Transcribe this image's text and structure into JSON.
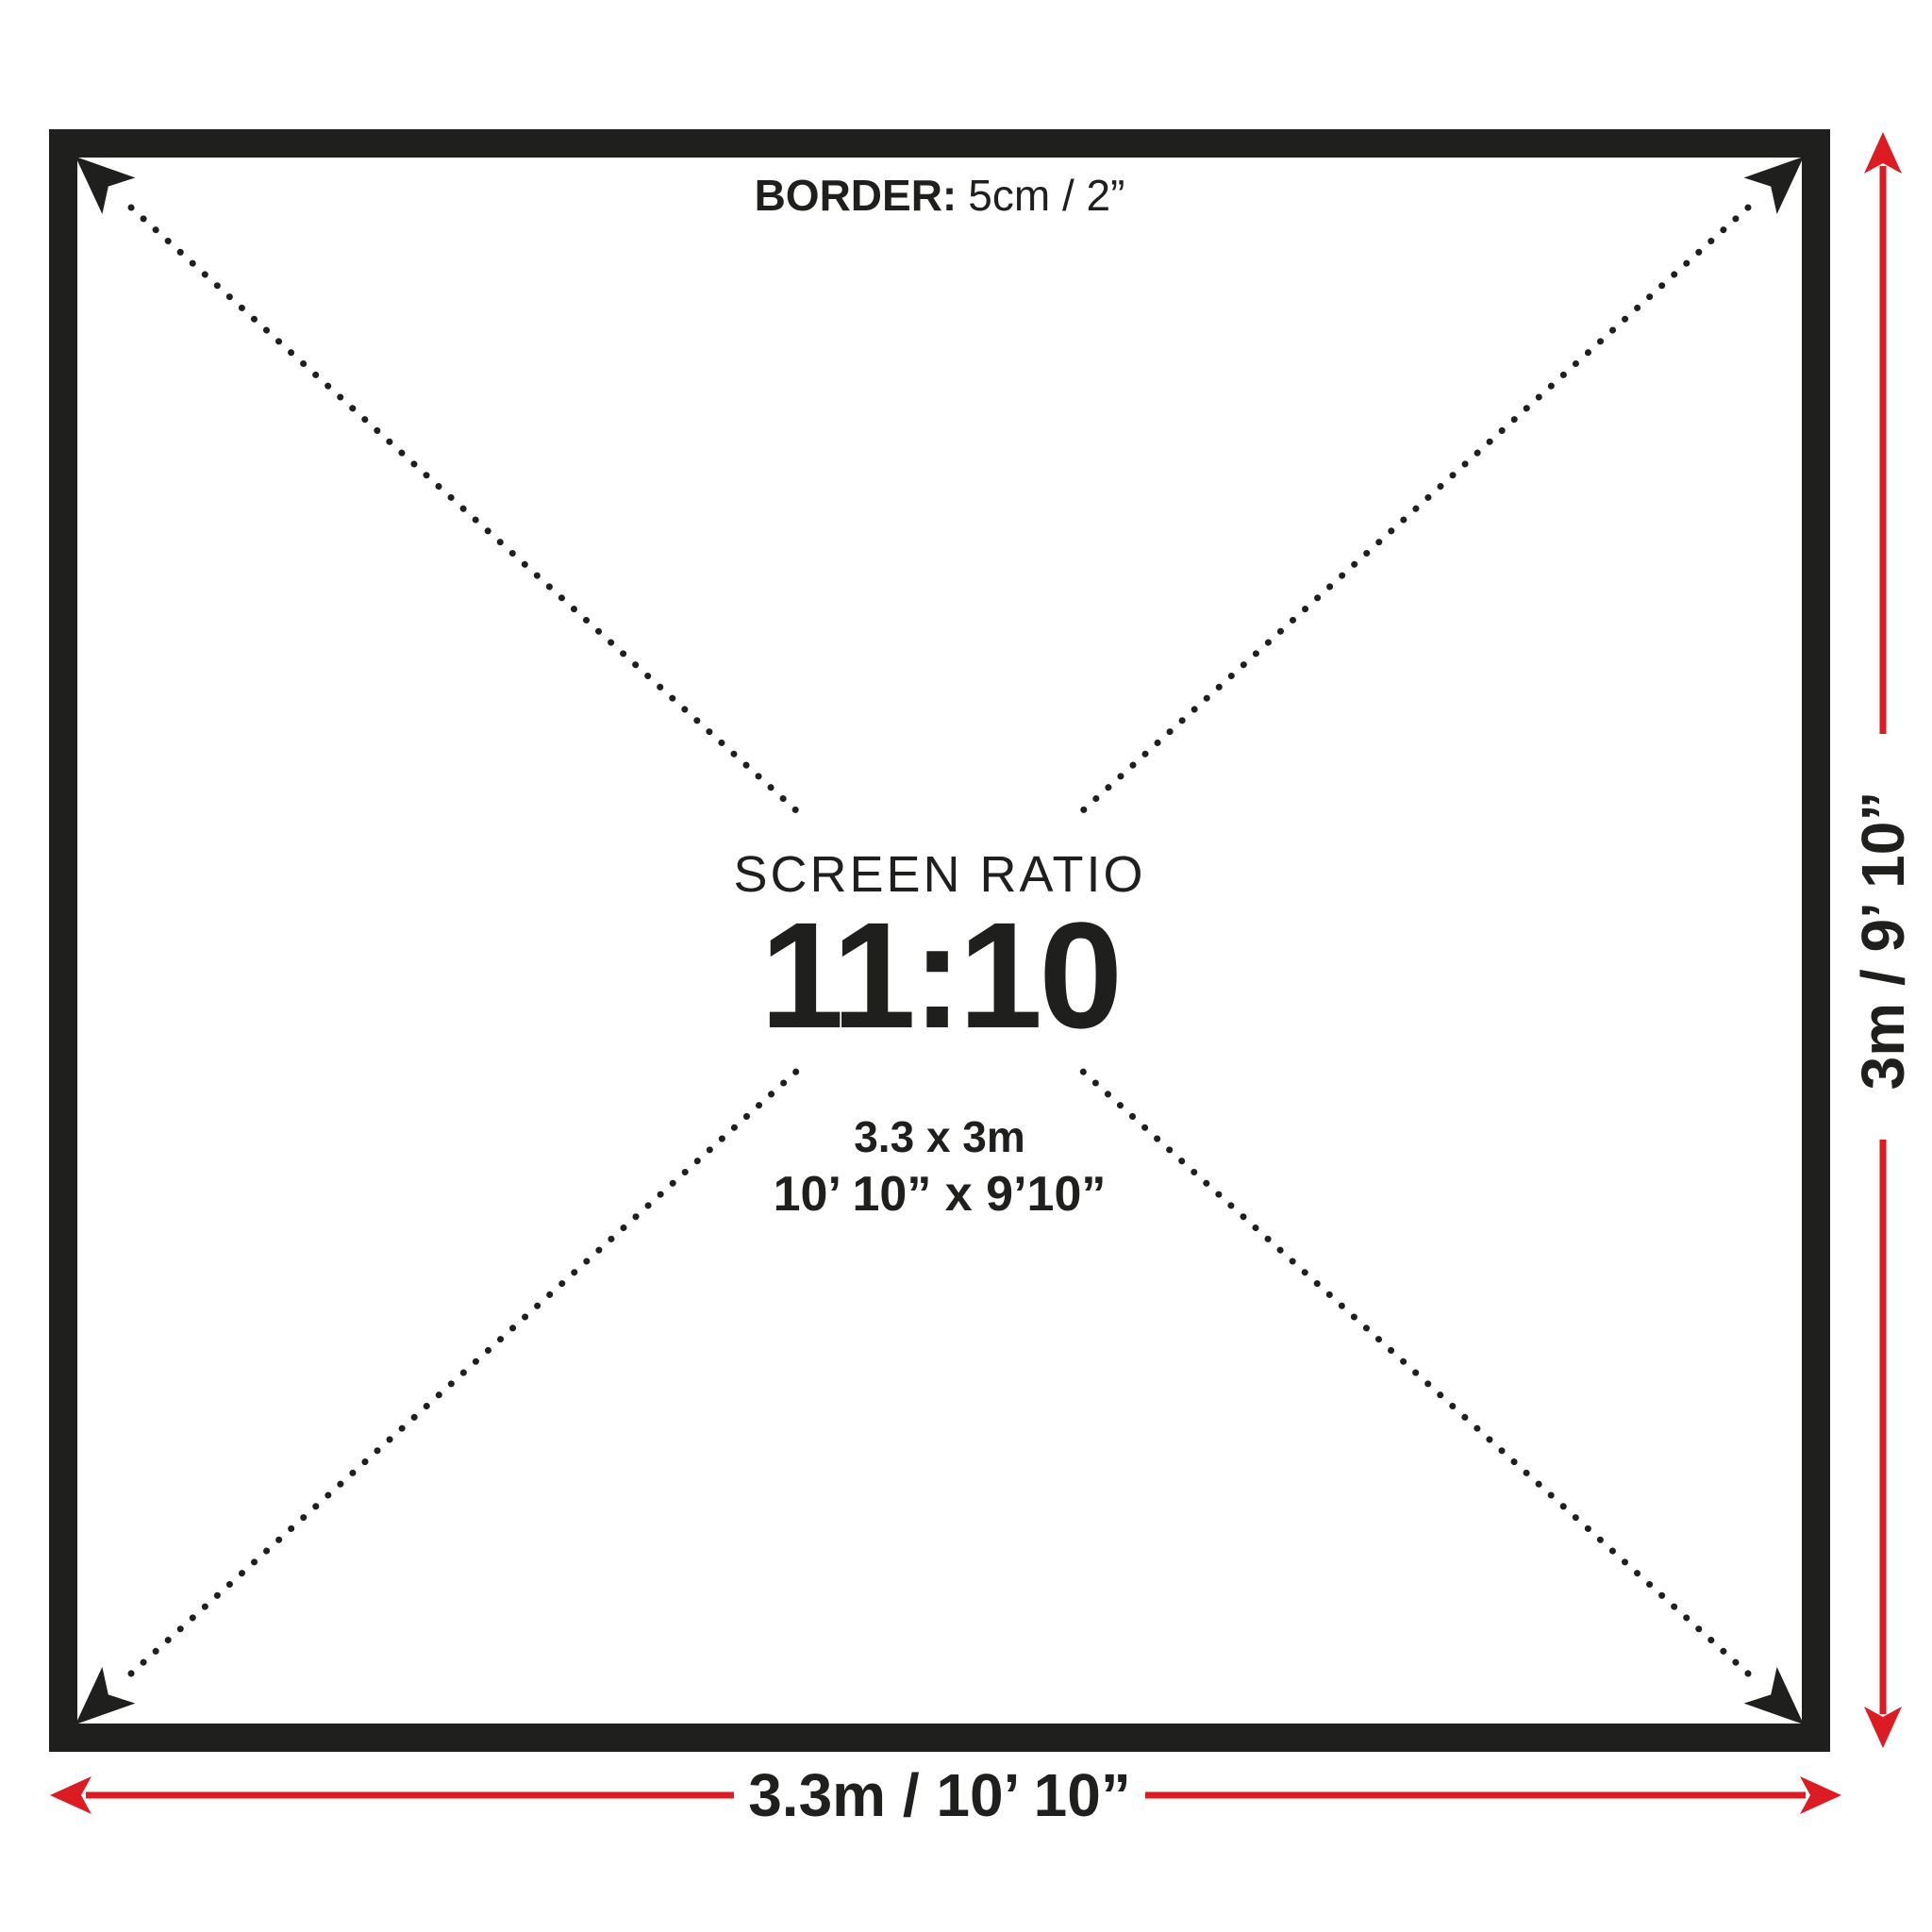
{
  "colors": {
    "ink": "#1f1f1d",
    "accent_red": "#dc1b22",
    "background": "#ffffff"
  },
  "border_note": {
    "label": "BORDER:",
    "value": "5cm / 2”"
  },
  "screen": {
    "ratio_title": "SCREEN RATIO",
    "ratio_value": "11:10",
    "size_metric": "3.3 x 3m",
    "size_imperial": "10’ 10” x 9’10”"
  },
  "dimensions": {
    "width_label": "3.3m / 10’ 10”",
    "height_label": "3m / 9’ 10”"
  },
  "icons": {
    "corner_arrow": "black dart arrowhead pointing into screen corner",
    "dimension_arrow": "red dart arrowhead on dimension line"
  }
}
